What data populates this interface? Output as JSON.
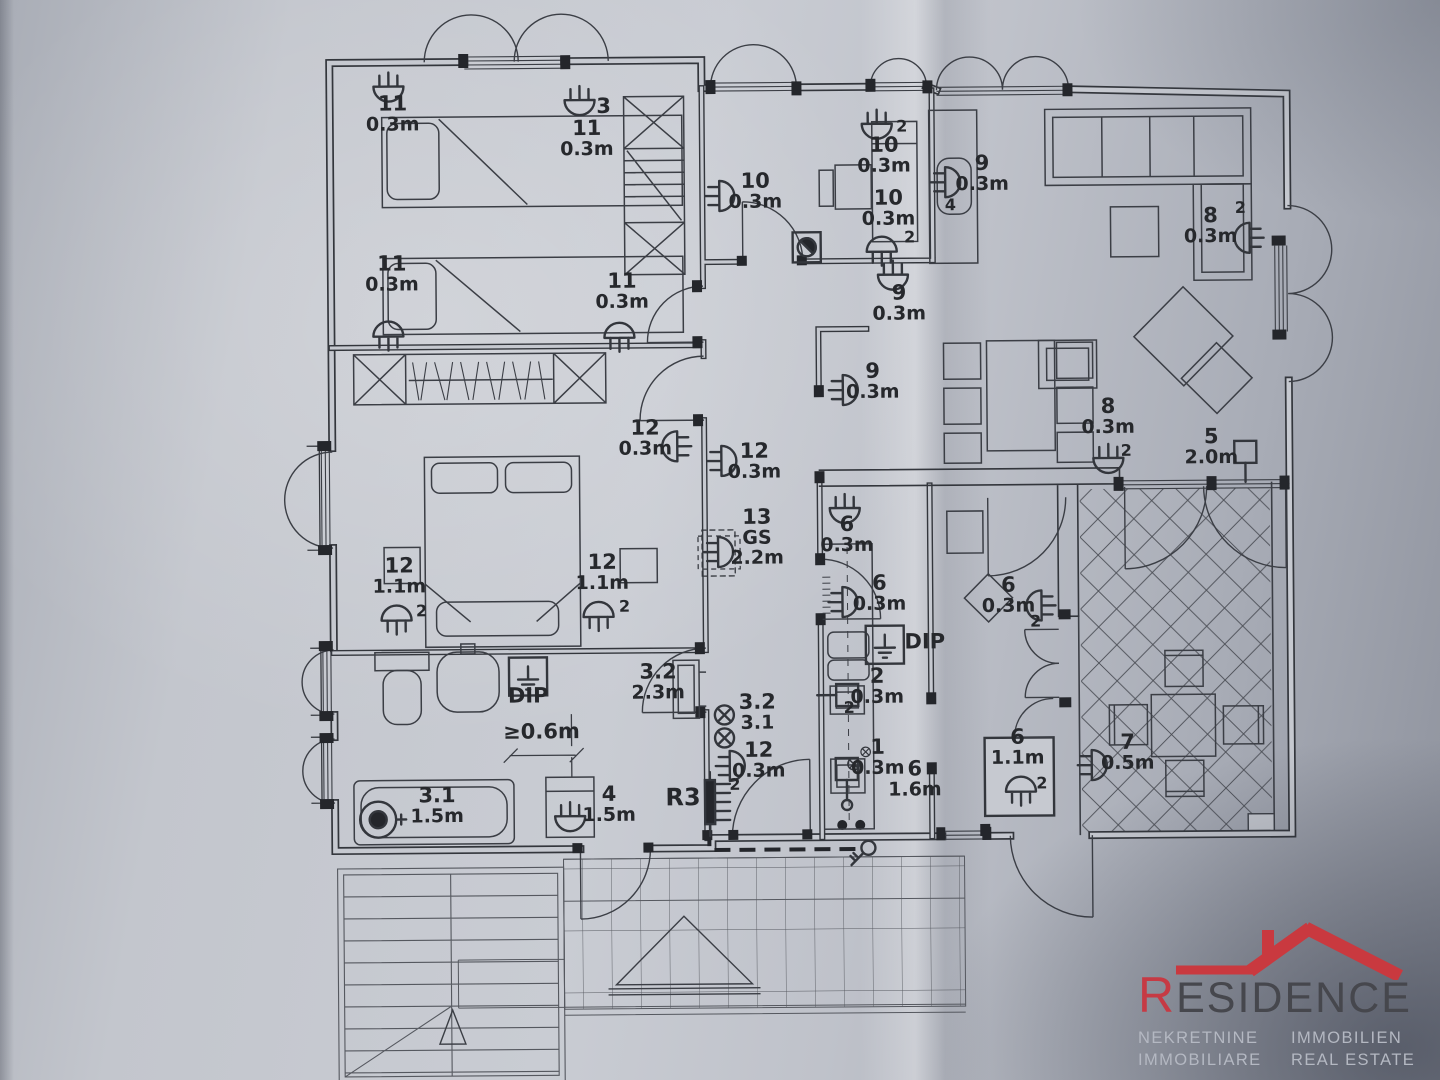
{
  "photo": {
    "paper_color": "#c6c9d0",
    "ink_color": "#33363c",
    "label_color": "#26282c"
  },
  "plan": {
    "annotations": [
      {
        "x": 396,
        "y": 108,
        "lines": [
          "11",
          "0.3m"
        ]
      },
      {
        "x": 394,
        "y": 268,
        "lines": [
          "11",
          "0.3m"
        ]
      },
      {
        "x": 607,
        "y": 112,
        "lines": [
          "3"
        ]
      },
      {
        "x": 590,
        "y": 134,
        "lines": [
          "11",
          "0.3m"
        ]
      },
      {
        "x": 758,
        "y": 188,
        "lines": [
          "10",
          "0.3m"
        ]
      },
      {
        "x": 905,
        "y": 133,
        "lines": [
          "2"
        ],
        "small": true
      },
      {
        "x": 887,
        "y": 153,
        "lines": [
          "10",
          "0.3m"
        ]
      },
      {
        "x": 891,
        "y": 206,
        "lines": [
          "10",
          "0.3m"
        ]
      },
      {
        "x": 912,
        "y": 244,
        "lines": [
          "2"
        ],
        "small": true
      },
      {
        "x": 985,
        "y": 172,
        "lines": [
          "9",
          "0.3m"
        ]
      },
      {
        "x": 953,
        "y": 212,
        "lines": [
          "4"
        ],
        "small": true
      },
      {
        "x": 901,
        "y": 301,
        "lines": [
          "9",
          "0.3m"
        ]
      },
      {
        "x": 624,
        "y": 287,
        "lines": [
          "11",
          "0.3m"
        ]
      },
      {
        "x": 1213,
        "y": 226,
        "lines": [
          "8",
          "0.3m"
        ]
      },
      {
        "x": 1243,
        "y": 217,
        "lines": [
          "2"
        ],
        "small": true
      },
      {
        "x": 646,
        "y": 434,
        "lines": [
          "12",
          "0.3m"
        ]
      },
      {
        "x": 755,
        "y": 458,
        "lines": [
          "12",
          "0.3m"
        ]
      },
      {
        "x": 874,
        "y": 379,
        "lines": [
          "9",
          "0.3m"
        ]
      },
      {
        "x": 1109,
        "y": 416,
        "lines": [
          "8",
          "0.3m"
        ]
      },
      {
        "x": 1127,
        "y": 459,
        "lines": [
          "2"
        ],
        "small": true
      },
      {
        "x": 1212,
        "y": 447,
        "lines": [
          "5",
          "2.0m"
        ]
      },
      {
        "x": 399,
        "y": 570,
        "lines": [
          "12",
          "1.1m"
        ]
      },
      {
        "x": 421,
        "y": 614,
        "lines": [
          "2"
        ],
        "small": true
      },
      {
        "x": 602,
        "y": 568,
        "lines": [
          "12",
          "1.1m"
        ]
      },
      {
        "x": 624,
        "y": 611,
        "lines": [
          "2"
        ],
        "small": true
      },
      {
        "x": 757,
        "y": 524,
        "lines": [
          "13",
          "GS",
          "2.2m"
        ]
      },
      {
        "x": 847,
        "y": 532,
        "lines": [
          "6",
          "0.3m"
        ]
      },
      {
        "x": 879,
        "y": 591,
        "lines": [
          "6",
          "0.3m"
        ]
      },
      {
        "x": 924,
        "y": 650,
        "lines": [
          "DIP"
        ]
      },
      {
        "x": 876,
        "y": 684,
        "lines": [
          "2",
          "0.3m"
        ]
      },
      {
        "x": 848,
        "y": 714,
        "lines": [
          "2"
        ],
        "small": true
      },
      {
        "x": 1008,
        "y": 594,
        "lines": [
          "6",
          "0.3m"
        ]
      },
      {
        "x": 1035,
        "y": 629,
        "lines": [
          "2"
        ],
        "small": true
      },
      {
        "x": 876,
        "y": 755,
        "lines": [
          "1",
          "0.3m"
        ]
      },
      {
        "x": 913,
        "y": 777,
        "lines": [
          "6",
          "1.6m"
        ]
      },
      {
        "x": 527,
        "y": 701,
        "lines": [
          "DIP"
        ]
      },
      {
        "x": 657,
        "y": 678,
        "lines": [
          "3.2",
          "2.3m"
        ]
      },
      {
        "x": 756,
        "y": 709,
        "lines": [
          "3.2",
          "3.1"
        ]
      },
      {
        "x": 757,
        "y": 757,
        "lines": [
          "12",
          "0.3m"
        ]
      },
      {
        "x": 733,
        "y": 790,
        "lines": [
          "2"
        ],
        "small": true
      },
      {
        "x": 681,
        "y": 805,
        "lines": [
          "R3"
        ],
        "big": true
      },
      {
        "x": 435,
        "y": 800,
        "lines": [
          "3.1",
          "1.5m"
        ]
      },
      {
        "x": 607,
        "y": 800,
        "lines": [
          "4",
          "1.5m"
        ]
      },
      {
        "x": 540,
        "y": 737,
        "lines": [
          "≥0.6m"
        ]
      },
      {
        "x": 1016,
        "y": 746,
        "lines": [
          "6",
          "1.1m"
        ]
      },
      {
        "x": 1040,
        "y": 791,
        "lines": [
          "2"
        ],
        "small": true
      },
      {
        "x": 1126,
        "y": 752,
        "lines": [
          "7",
          "0.5m"
        ]
      }
    ],
    "fixtures": [
      {
        "t": "lamp",
        "x": 392,
        "y": 84,
        "r": 0
      },
      {
        "t": "lamp",
        "x": 583,
        "y": 99,
        "r": 0
      },
      {
        "t": "lamp",
        "x": 390,
        "y": 334,
        "r": 180
      },
      {
        "t": "lamp",
        "x": 722,
        "y": 196,
        "r": 270
      },
      {
        "t": "lamp",
        "x": 880,
        "y": 125,
        "r": 0
      },
      {
        "t": "lamp",
        "x": 884,
        "y": 253,
        "r": 180
      },
      {
        "t": "lamp",
        "x": 948,
        "y": 184,
        "r": 270
      },
      {
        "t": "lamp",
        "x": 895,
        "y": 276,
        "r": 0
      },
      {
        "t": "lamp",
        "x": 844,
        "y": 391,
        "r": 270
      },
      {
        "t": "lamp",
        "x": 1252,
        "y": 242,
        "r": 90
      },
      {
        "t": "lamp",
        "x": 621,
        "y": 337,
        "r": 180
      },
      {
        "t": "lamp",
        "x": 678,
        "y": 446,
        "r": 90
      },
      {
        "t": "lamp",
        "x": 722,
        "y": 461,
        "r": 270
      },
      {
        "t": "lamp",
        "x": 1109,
        "y": 461,
        "r": 0
      },
      {
        "t": "lamp",
        "x": 396,
        "y": 618,
        "r": 180
      },
      {
        "t": "lamp",
        "x": 598,
        "y": 616,
        "r": 180
      },
      {
        "t": "lamp",
        "x": 845,
        "y": 509,
        "r": 0
      },
      {
        "t": "lamp",
        "x": 842,
        "y": 603,
        "r": 270
      },
      {
        "t": "lamp",
        "x": 1041,
        "y": 608,
        "r": 90
      },
      {
        "t": "lamp",
        "x": 728,
        "y": 766,
        "r": 270
      },
      {
        "t": "lamp",
        "x": 568,
        "y": 815,
        "r": 0
      },
      {
        "t": "lamp",
        "x": 1019,
        "y": 794,
        "r": 180
      },
      {
        "t": "lamp",
        "x": 1090,
        "y": 768,
        "r": 270
      },
      {
        "t": "lampd",
        "x": 718,
        "y": 552,
        "r": 270
      },
      {
        "t": "socket",
        "x": 1246,
        "y": 456,
        "r": 0
      },
      {
        "t": "socket",
        "x": 846,
        "y": 696,
        "r": 90
      },
      {
        "t": "socketo",
        "x": 845,
        "y": 770,
        "r": 0
      },
      {
        "t": "dip",
        "x": 884,
        "y": 646,
        "r": 0
      },
      {
        "t": "dip",
        "x": 527,
        "y": 675,
        "r": 0
      },
      {
        "t": "cx",
        "x": 723,
        "y": 715,
        "r": 0,
        "sc": 1
      },
      {
        "t": "cx",
        "x": 723,
        "y": 738,
        "r": 0,
        "sc": 1
      },
      {
        "t": "cx",
        "x": 852,
        "y": 765,
        "r": 0,
        "sc": 0.62
      },
      {
        "t": "cx",
        "x": 864,
        "y": 753,
        "r": 0,
        "sc": 0.5
      },
      {
        "t": "panel",
        "x": 708,
        "y": 802,
        "r": 0
      },
      {
        "t": "bull",
        "x": 376,
        "y": 817,
        "r": 0
      },
      {
        "t": "key",
        "x": 866,
        "y": 849,
        "r": 0
      },
      {
        "t": "det",
        "x": 809,
        "y": 248,
        "r": 0
      }
    ]
  },
  "logo": {
    "brand_initial": "R",
    "brand_rest": "ESIDENCE",
    "roof_color": "#c9393f",
    "brand_color": "#46474d",
    "tagline_color": "#b4b8c2",
    "taglines": {
      "row1_left": "NEKRETNINE",
      "row1_right": "IMMOBILIEN",
      "row2_left": "IMMOBILIARE",
      "row2_right": "REAL ESTATE"
    }
  }
}
